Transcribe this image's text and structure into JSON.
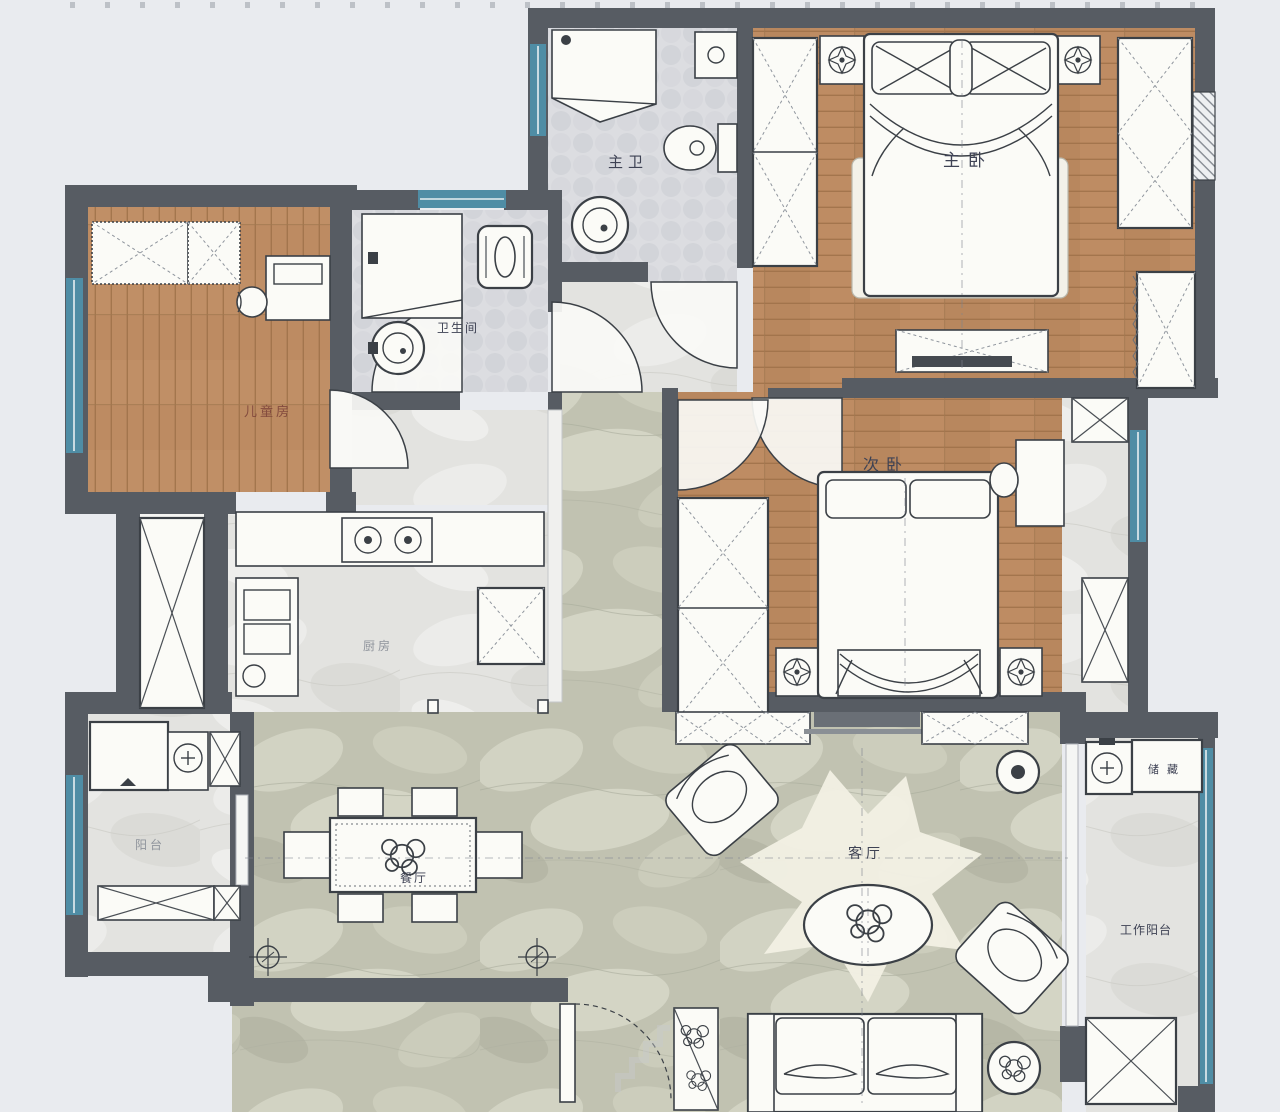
{
  "palette": {
    "background": "#e9ebef",
    "wall": "#575c63",
    "window_teal": "#4f8da5",
    "wood_floor": "#b8875e",
    "marble_floor_green": "#c1c2b1",
    "light_floor": "#e3e3e0",
    "furniture_line": "#3b4046",
    "label_color": "#3e4254"
  },
  "rooms": {
    "master_bath": {
      "label": "主卫"
    },
    "master_bedroom": {
      "label": "主卧"
    },
    "bathroom": {
      "label": "卫生间"
    },
    "kids_room": {
      "label": "儿童房"
    },
    "second_bedroom": {
      "label": "次卧"
    },
    "kitchen": {
      "label": "厨房"
    },
    "balcony": {
      "label": "阳台"
    },
    "dining_room": {
      "label": "餐厅"
    },
    "living_room": {
      "label": "客厅"
    },
    "storage_cabinet": {
      "label": "储藏"
    },
    "work_balcony": {
      "label": "工作阳台"
    }
  }
}
